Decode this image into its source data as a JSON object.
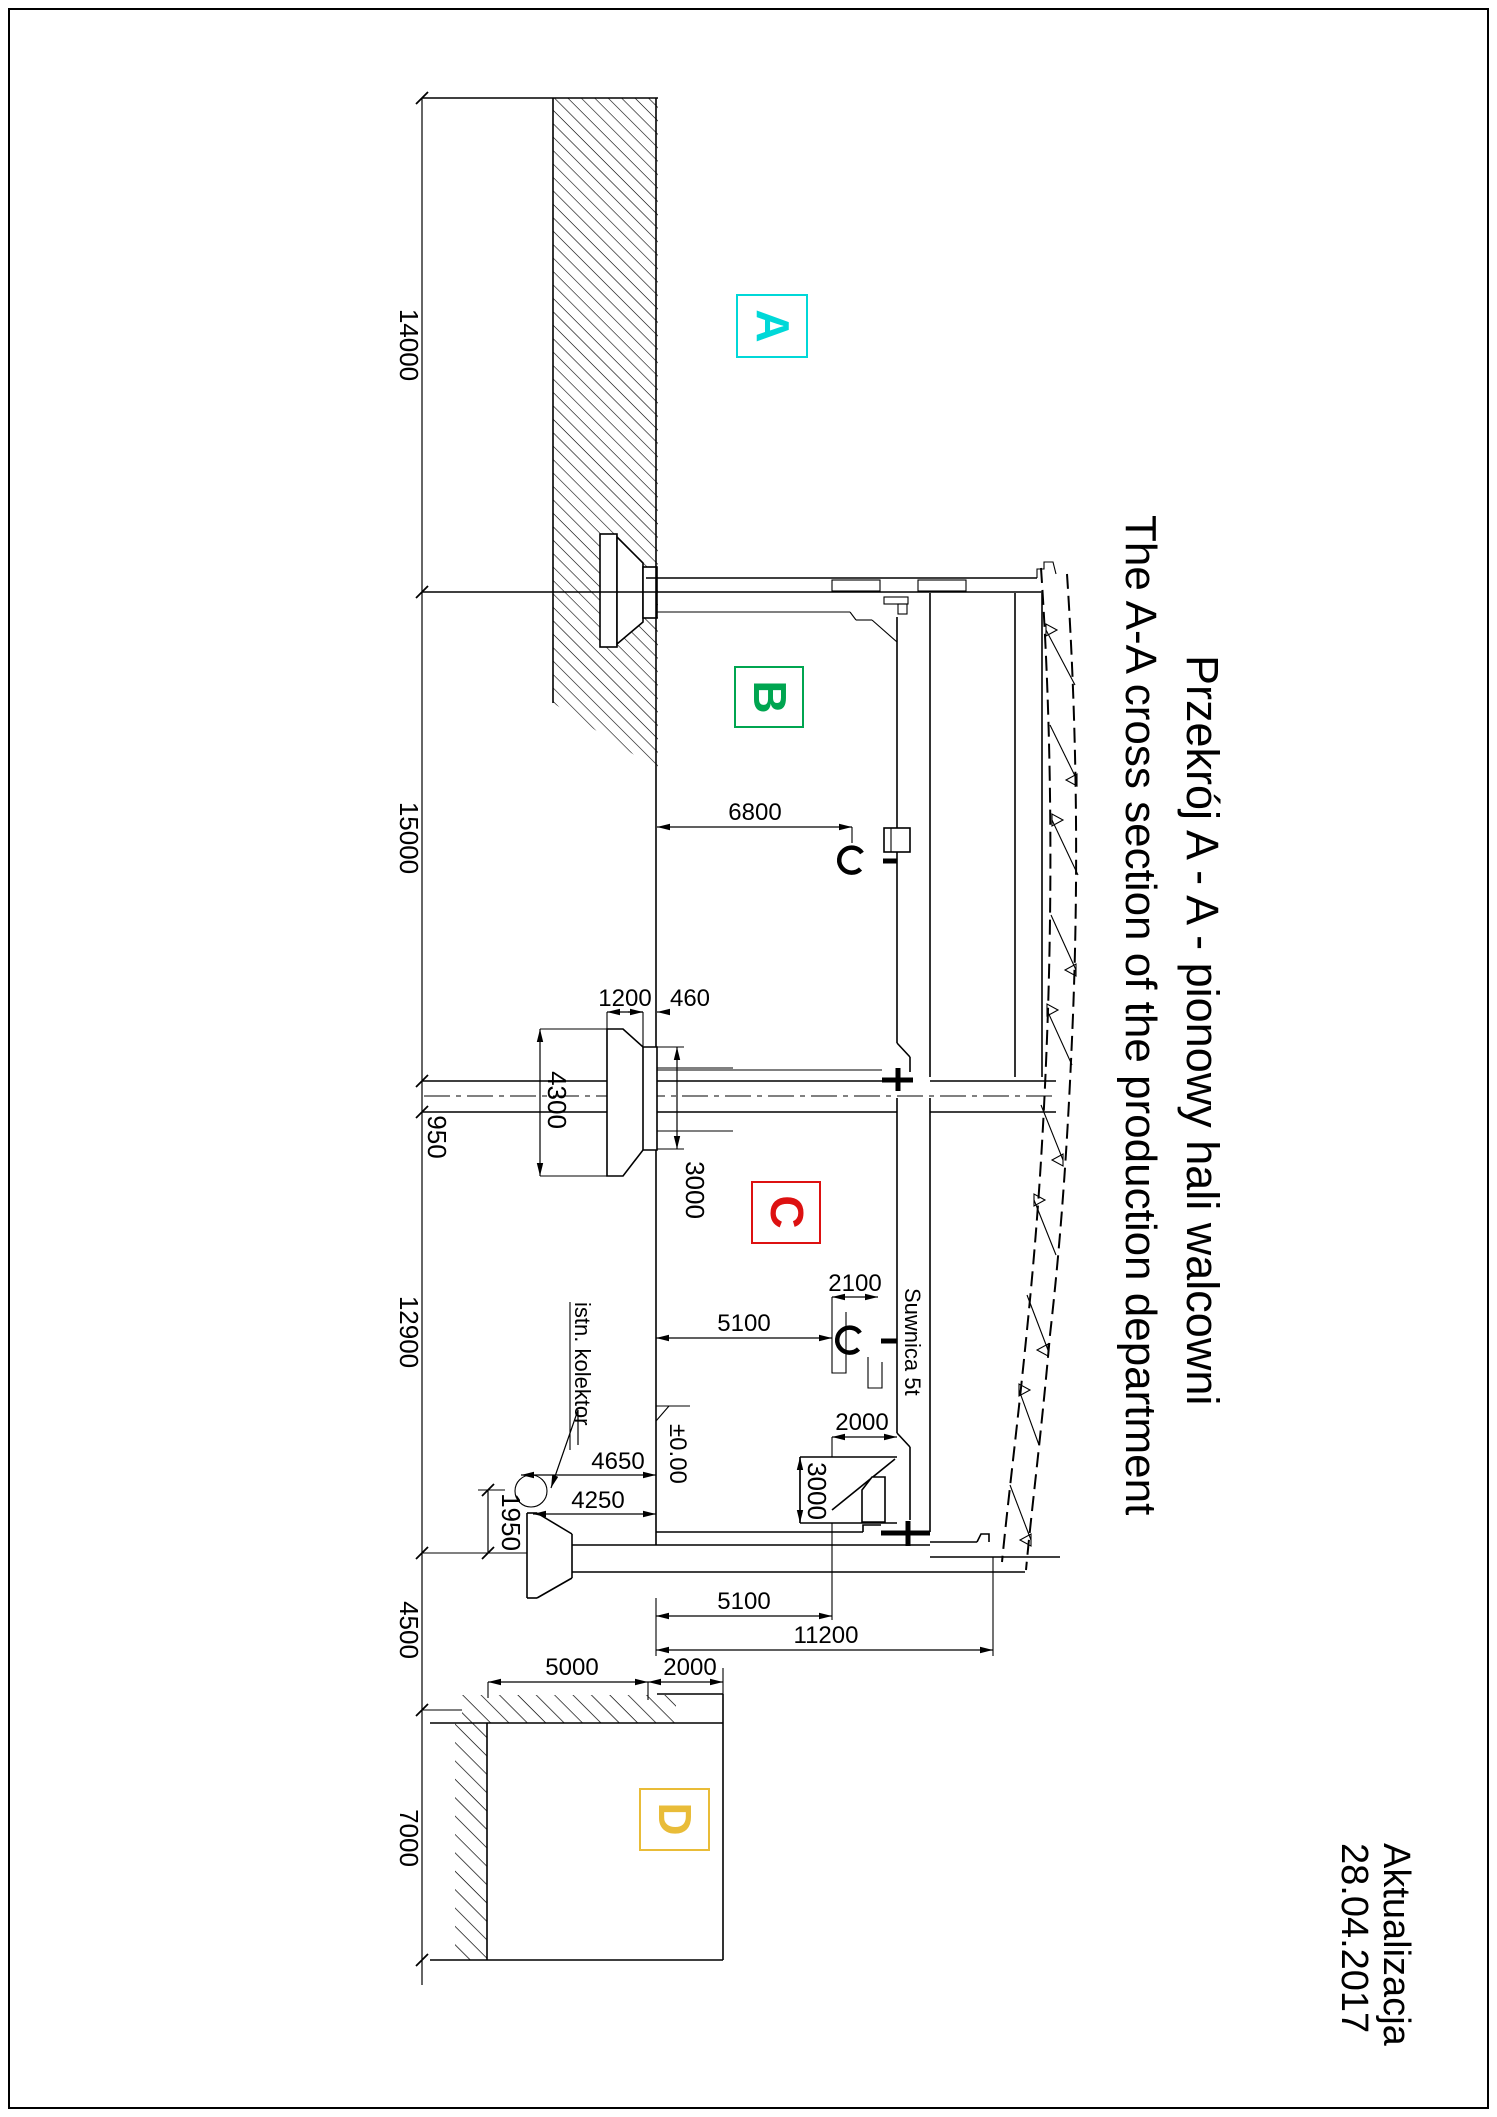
{
  "sheet": {
    "width": "1497",
    "height": "2117",
    "background": "#ffffff",
    "border_color": "#000000"
  },
  "title_block": {
    "title_pl": "Przekrój A - A - pionowy hali walcowni",
    "title_en": "The A-A cross section of the production department"
  },
  "revision": {
    "label": "Aktualizacja",
    "date": "28.04.2017"
  },
  "zones": {
    "a": {
      "letter": "A",
      "color": "#00d8d8"
    },
    "b": {
      "letter": "B",
      "color": "#00a550"
    },
    "c": {
      "letter": "C",
      "color": "#dd1111"
    },
    "d": {
      "letter": "D",
      "color": "#e9bc38"
    }
  },
  "notes": {
    "crane": "Suwnica 5t",
    "collector": "istn. kolektor",
    "level": "±0.00"
  },
  "dims": {
    "chain": [
      "14000",
      "15000",
      "950",
      "12900",
      "4500",
      "7000"
    ],
    "hall_b_width": "6800",
    "corbel_top": "1200",
    "corbel_edge": "460",
    "column_height": "4300",
    "corbel_face": "3000",
    "bracket_width": "2100",
    "rail_upper": "5100",
    "pit_width": "2000",
    "pit_depth": "3000",
    "collector_top": "4650",
    "collector_axis": "4250",
    "collector_drop": "1950",
    "rail_lower": "5100",
    "hall_c_span": "11200",
    "cellar_width": "5000",
    "cellar_wall": "2000"
  }
}
